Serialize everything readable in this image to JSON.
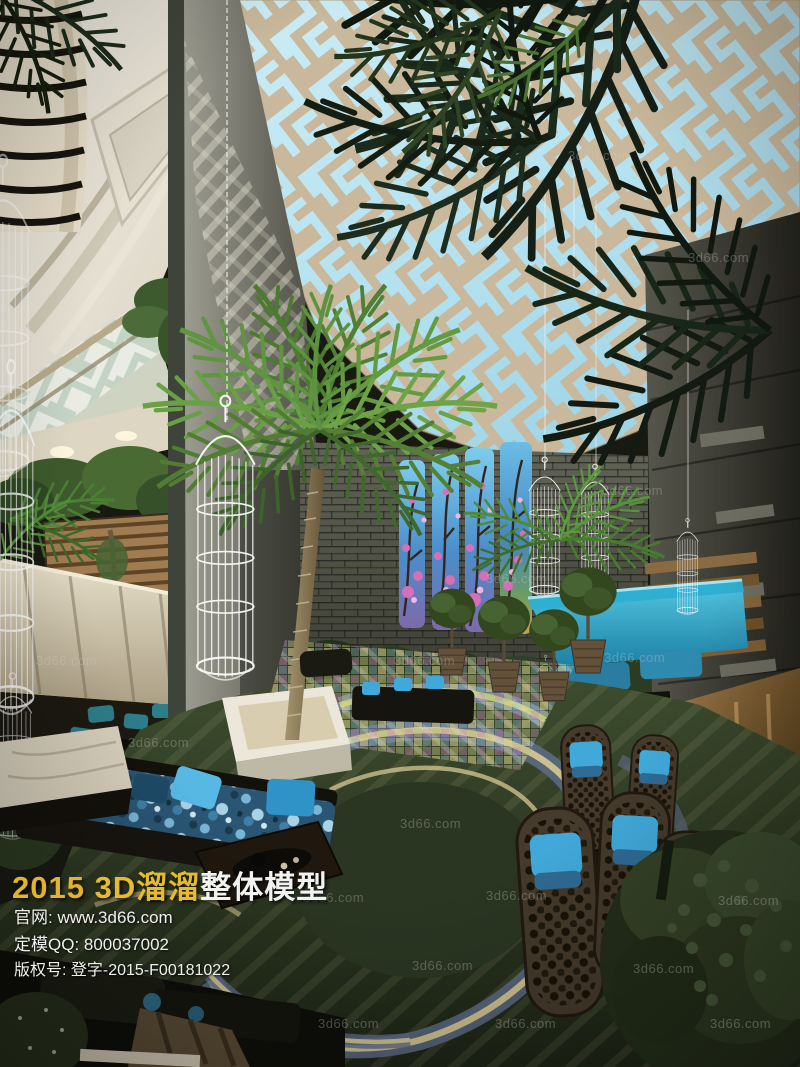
{
  "watermark": {
    "text": "3d66.com"
  },
  "overlay": {
    "title_year": "2015",
    "title_brand": "3D溜溜",
    "title_suffix": "整体模型",
    "line_website": "官网: www.3d66.com",
    "line_qq": "定模QQ: 800037002",
    "line_copyright": "版权号: 登字-2015-F00181022"
  },
  "colors": {
    "sky": "#cdeef6",
    "sky_deep": "#9ed4e6",
    "lattice": "#c9b89b",
    "canopy_turquoise": "#2fb0d2",
    "carpet_green": "#3d4c2e",
    "carpet_dark": "#1d2516",
    "mural_blossom_pink": "#d66fb8",
    "cushion_blue": "#41a9da",
    "title_gold": "#e2b32b",
    "title_white": "#f2f2f0"
  }
}
